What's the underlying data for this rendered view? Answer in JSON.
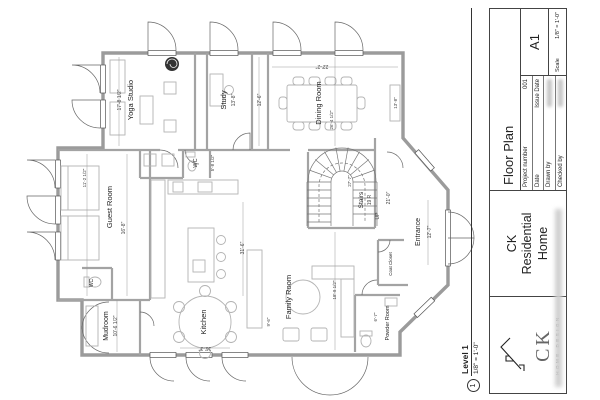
{
  "sheet": {
    "title_block": {
      "sheet_name": "Floor Plan",
      "fields": [
        {
          "label": "Project number",
          "value": "001"
        },
        {
          "label": "Date",
          "value": "Issue Date"
        },
        {
          "label": "Drawn by",
          "value": ""
        },
        {
          "label": "Checked by",
          "value": ""
        }
      ],
      "sheet_number": "A1",
      "scale_label": "Scale",
      "scale_value": "1/8\" = 1'-0\"",
      "project_name_lines": [
        "CK",
        "Residential",
        "Home"
      ],
      "logo_initials": "CK",
      "logo_subtitle": "HOME DESIGN"
    },
    "view_title": {
      "number": "1",
      "name": "Level 1",
      "scale": "1/8\" = 1'-0\""
    }
  },
  "plan": {
    "rooms": {
      "yoga": "Yoga Studio",
      "study": "Study",
      "dining": "Dining Room",
      "guest": "Guest Room",
      "wc1": "WC",
      "wc2": "WC",
      "stairs": "Stairs",
      "entrance": "Entrance",
      "mudroom": "Mudroom",
      "kitchen": "Kitchen",
      "family": "Family Room",
      "powder": "Powder Room",
      "coat": "Coat Closet"
    },
    "dims": {
      "yoga": "17'-8 1/2\"",
      "study": "13'-8\"",
      "dining_w": "22'-2\"",
      "dining_d": "12'-6\"",
      "sideboard": "13'-8\"",
      "hall": "26'-4 1/2\"",
      "guest": "16'-8\"",
      "guest_w": "11'-2 1/2\"",
      "wc1": "5'-8 1/2\"",
      "stairs_risers": "19 R",
      "stairs_up": "UP",
      "stairs_run": "21'-0\"",
      "stairs_w": "27'-7\"",
      "entrance": "12'-7\"",
      "mudroom": "10'-6 1/2\"",
      "kitchen": "16'-3\"",
      "kitchen_l": "31'-6\"",
      "family": "18'-9 1/2\"",
      "family_w": "9'-6\"",
      "powder": "6'-7\""
    }
  },
  "colors": {
    "wall": "#9b9b9b",
    "line": "#2a2a2a",
    "dim": "#555555"
  }
}
